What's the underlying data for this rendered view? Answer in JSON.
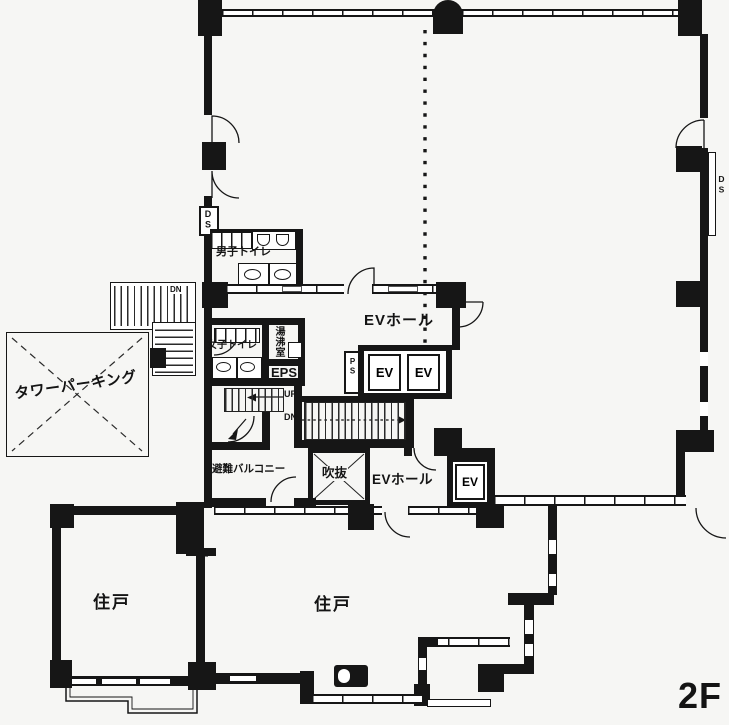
{
  "floor_plan": {
    "floor_label": "2F",
    "rooms": {
      "tower_parking": "タワーパーキング",
      "mens_toilet": "男子トイレ",
      "womens_toilet": "女子トイレ",
      "hot_water_room": "湯沸室",
      "eps_shaft": "EPS",
      "pipe_shaft": "PS",
      "upper_ev_hall": "EVホール",
      "lower_ev_hall": "EVホール",
      "elevator_1": "EV",
      "elevator_2": "EV",
      "elevator_3": "EV",
      "evacuation_balcony": "避難バルコニー",
      "atrium_void": "吹抜",
      "dwelling_unit_left": "住戸",
      "dwelling_unit_right": "住戸"
    },
    "shafts": {
      "duct_space_left": "DS",
      "duct_space_right": "DS"
    },
    "stairs": {
      "up_label": "UP",
      "down_label_internal": "DN",
      "down_label_external": "DN"
    },
    "colors": {
      "line": "#161616",
      "paper": "#f6f6f4"
    }
  }
}
